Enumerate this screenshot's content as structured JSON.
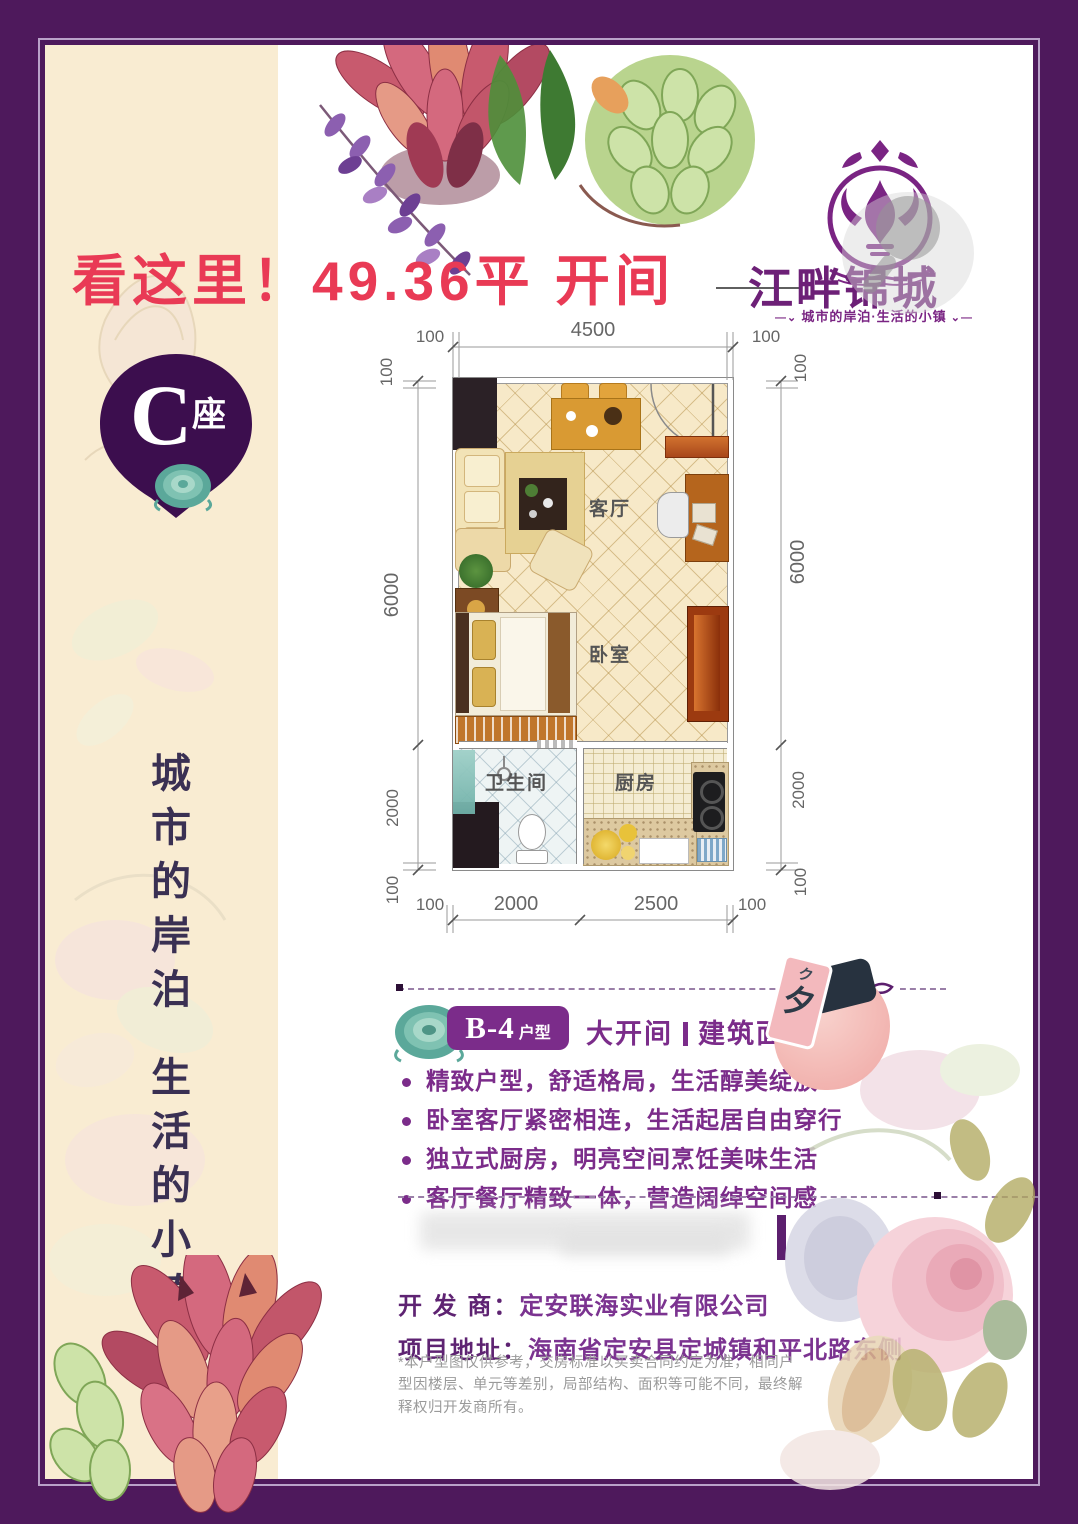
{
  "headline": "看这里！49.36平 开间",
  "logo": {
    "name": "江畔锦城",
    "tagline": "城市的岸泊·生活的小镇"
  },
  "block_badge": {
    "letter": "C",
    "suffix": "座"
  },
  "slogan": {
    "part1": "城市的岸泊",
    "part2": "生活的小镇"
  },
  "floorplan": {
    "labels": {
      "living": "客厅",
      "bedroom": "卧室",
      "bathroom": "卫生间",
      "kitchen": "厨房"
    },
    "dims": {
      "top_left_100": "100",
      "top_4500": "4500",
      "top_right_100": "100",
      "left_100_top": "100",
      "left_6000": "6000",
      "left_2000": "2000",
      "left_100_bottom": "100",
      "right_100_top": "100",
      "right_6000": "6000",
      "right_2000": "2000",
      "right_100_bottom": "100",
      "bottom_100_left": "100",
      "bottom_2000": "2000",
      "bottom_2500": "2500",
      "bottom_100_right": "100"
    }
  },
  "unit_section": {
    "badge": "B-4",
    "badge_suffix": "户型",
    "tag": "大开间",
    "area_label": "建筑面积约",
    "sticker_char_small": "ク",
    "sticker_char": "夕",
    "features": [
      "精致户型，舒适格局，生活醇美绽放",
      "卧室客厅紧密相连，生活起居自由穿行",
      "独立式厨房，明亮空间烹饪美味生活",
      "客厅餐厅精致一体，营造阔绰空间感"
    ]
  },
  "info": {
    "dev_label": "开 发 商：",
    "dev_value": "定安联海实业有限公司",
    "addr_label": "项目地址：",
    "addr_value": "海南省定安县定城镇和平北路东侧"
  },
  "disclaimer": "*本户型图仅供参考，交房标准以买卖合同约定为准，相同户型因楼层、单元等差别，局部结构、面积等可能不同，最终解释权归开发商所有。",
  "colors": {
    "border_purple": "#4e195c",
    "accent_purple": "#7b2c8a",
    "headline_red": "#e93a55",
    "badge_purple": "#3c0e4e",
    "cream": "#f9ecd2"
  }
}
